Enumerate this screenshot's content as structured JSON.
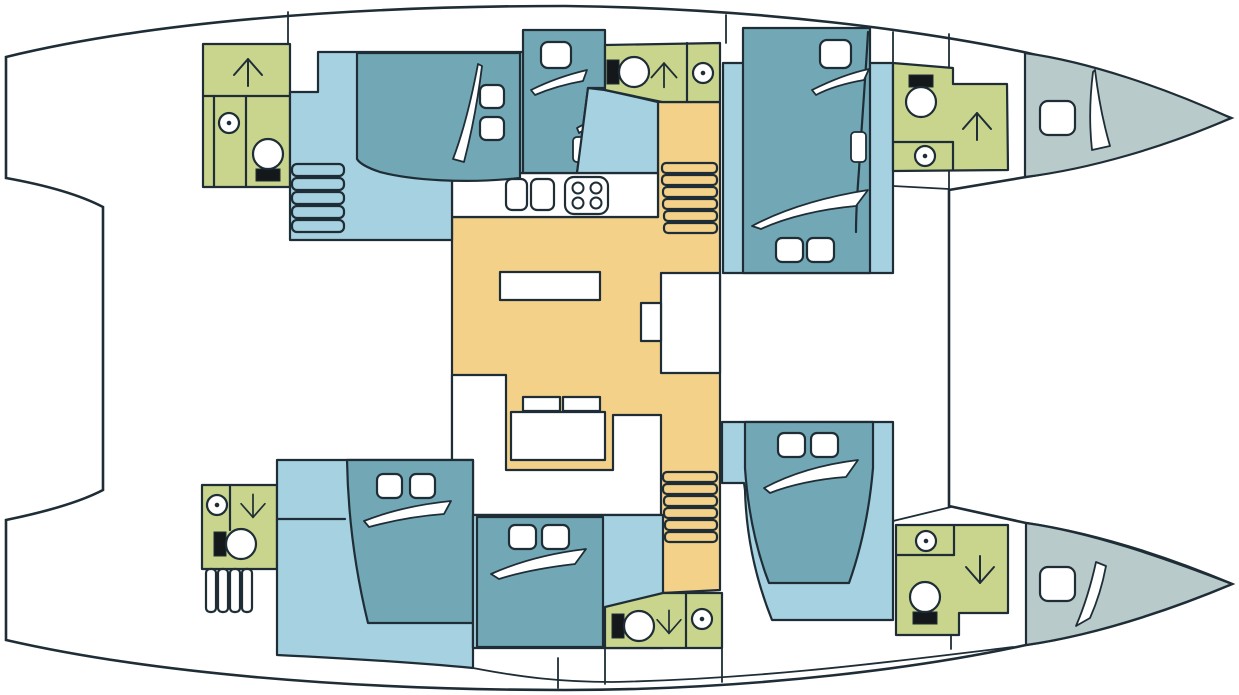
{
  "palette": {
    "outline": "#1e2d36",
    "deck_white": "#ffffff",
    "cabin_floor": "#a6d1e0",
    "bed_teal": "#72a8b6",
    "bathroom_green": "#c9d58c",
    "salon_orange": "#f4d189",
    "crew_gray": "#b9cacb",
    "fixture_black": "#14181b"
  },
  "plan": {
    "vessel_type": "catamaran",
    "view": "deck layout, top view, bow to the right",
    "salon": {
      "name": "Saloon and galley",
      "fixtures": [
        "galley-counter",
        "double-galley-sink",
        "four-burner-stove",
        "u-shaped-settee",
        "saloon-table",
        "seat-cushions",
        "sideboard",
        "chart-table",
        "companionway-stairs-top-hull",
        "companionway-stairs-bottom-hull"
      ]
    },
    "hull_top": {
      "name": "Upper hull",
      "rooms": [
        {
          "name": "Aft head",
          "type": "bathroom",
          "fixtures": [
            "shower",
            "washbasin",
            "toilet"
          ]
        },
        {
          "name": "Aft double cabin",
          "type": "cabin",
          "fixtures": [
            "double-berth",
            "two-pillows",
            "cabin-steps"
          ]
        },
        {
          "name": "Midship berth",
          "type": "cabin",
          "fixtures": [
            "single-berth",
            "pillow"
          ]
        },
        {
          "name": "Mid head",
          "type": "bathroom",
          "fixtures": [
            "toilet",
            "shower",
            "washbasin"
          ]
        },
        {
          "name": "Forward double cabin",
          "type": "cabin",
          "fixtures": [
            "island-double-berth",
            "single-berth",
            "pillows"
          ]
        },
        {
          "name": "Forward head",
          "type": "bathroom",
          "fixtures": [
            "toilet",
            "shower",
            "washbasin"
          ]
        },
        {
          "name": "Bow crew berth",
          "type": "crew cabin",
          "fixtures": [
            "single-berth",
            "pillow"
          ]
        }
      ]
    },
    "hull_bottom": {
      "name": "Lower hull",
      "rooms": [
        {
          "name": "Aft head",
          "type": "bathroom",
          "fixtures": [
            "washbasin",
            "shower",
            "toilet",
            "deck-steps"
          ]
        },
        {
          "name": "Aft double cabin",
          "type": "cabin",
          "fixtures": [
            "double-berth",
            "two-pillows"
          ]
        },
        {
          "name": "Mid double cabin",
          "type": "cabin",
          "fixtures": [
            "double-berth",
            "two-pillows"
          ]
        },
        {
          "name": "Mid head",
          "type": "bathroom",
          "fixtures": [
            "toilet",
            "shower",
            "washbasin"
          ]
        },
        {
          "name": "Forward double cabin",
          "type": "cabin",
          "fixtures": [
            "island-double-berth",
            "two-pillows"
          ]
        },
        {
          "name": "Forward head",
          "type": "bathroom",
          "fixtures": [
            "washbasin",
            "shower",
            "toilet"
          ]
        },
        {
          "name": "Bow crew berth",
          "type": "crew cabin",
          "fixtures": [
            "single-berth",
            "pillow"
          ]
        }
      ]
    }
  }
}
